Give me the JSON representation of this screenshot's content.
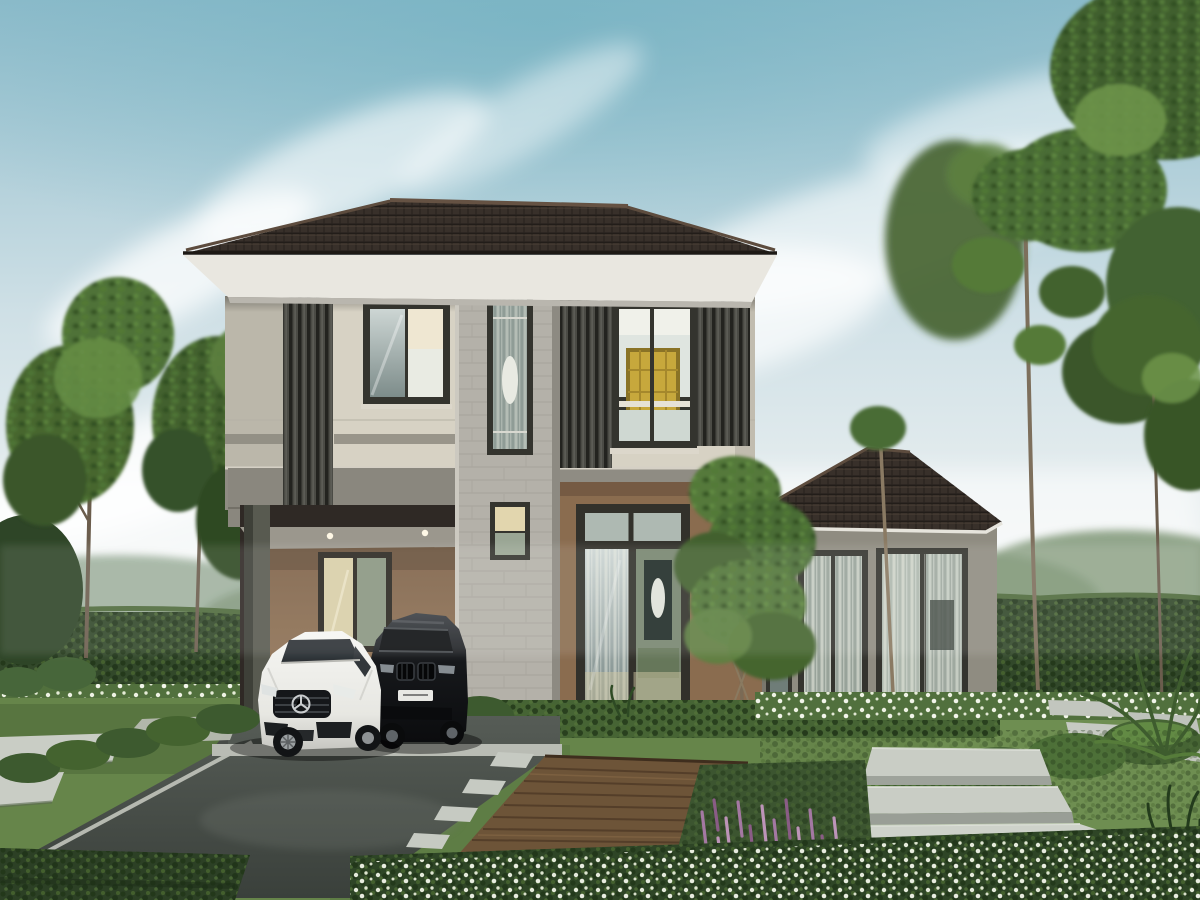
{
  "meta": {
    "title": "Architectural rendering: modern two-storey house with carport, two cars and landscaped garden"
  },
  "objects": {
    "scene": "house-exterior-rendering",
    "sky": "sky-with-clouds",
    "house": "two-storey-modern-house",
    "roof": "dark-tile-hip-roof",
    "carport": "carport-with-cars",
    "white_car": "white-sports-car",
    "black_car": "black-suv",
    "entrance": "glass-entrance-door",
    "wing": "single-storey-right-wing",
    "garden": "landscaped-garden",
    "driveway": "driveway",
    "deck": "wood-deck-path",
    "steps": "stone-slab-steps",
    "hedge": "hedge-wall",
    "trees": "garden-trees",
    "flowers": "flower-beds"
  },
  "palette": {
    "sky_top": "#8fbccb",
    "sky_mid": "#cfe0e6",
    "sky_horizon": "#eef2f2",
    "cloud_white": "#ffffff",
    "haze_tree": "#91a68c",
    "roof_dark": "#38302a",
    "roof_ridge": "#655243",
    "fascia_white": "#e9e7e0",
    "wall_cream": "#d7d2c4",
    "wall_shade": "#b2ada1",
    "louver_dark": "#4b4b45",
    "frame_dark": "#34342e",
    "glass_cool": "#93a1a1",
    "glass_bright": "#e9ebe3",
    "glow_warm": "#e3d4ae",
    "art_yellow": "#c7a83c",
    "slab_gray": "#8f8c83",
    "soffit_gray": "#9b978d",
    "brown_wall": "#8a6c4f",
    "brown_wall_dark": "#6f5640",
    "stone_pier": "#b4b1a9",
    "wing_wall": "#8f8c81",
    "hedge_dark": "#32482a",
    "hedge_mid": "#466434",
    "hedge_light": "#5f8142",
    "tree_dark": "#2f4a24",
    "tree_mid": "#4a6c34",
    "tree_light": "#6d9449",
    "trunk": "#786a56",
    "lawn": "#66854a",
    "lawn_dark": "#56733f",
    "driveway": "#4b514c",
    "curb": "#c2c5bc",
    "paver": "#c9cdc5",
    "deck": "#6d5438",
    "deck_line": "#503b27",
    "flower_white_base": "#2e4526",
    "flower_purple": "#a478a2",
    "purple_base": "#3c5530",
    "car_white": "#f3f3ef",
    "car_black": "#17191c",
    "column_gray": "#585a50",
    "step_face": "#62665f",
    "pool_dark": "#323830"
  }
}
